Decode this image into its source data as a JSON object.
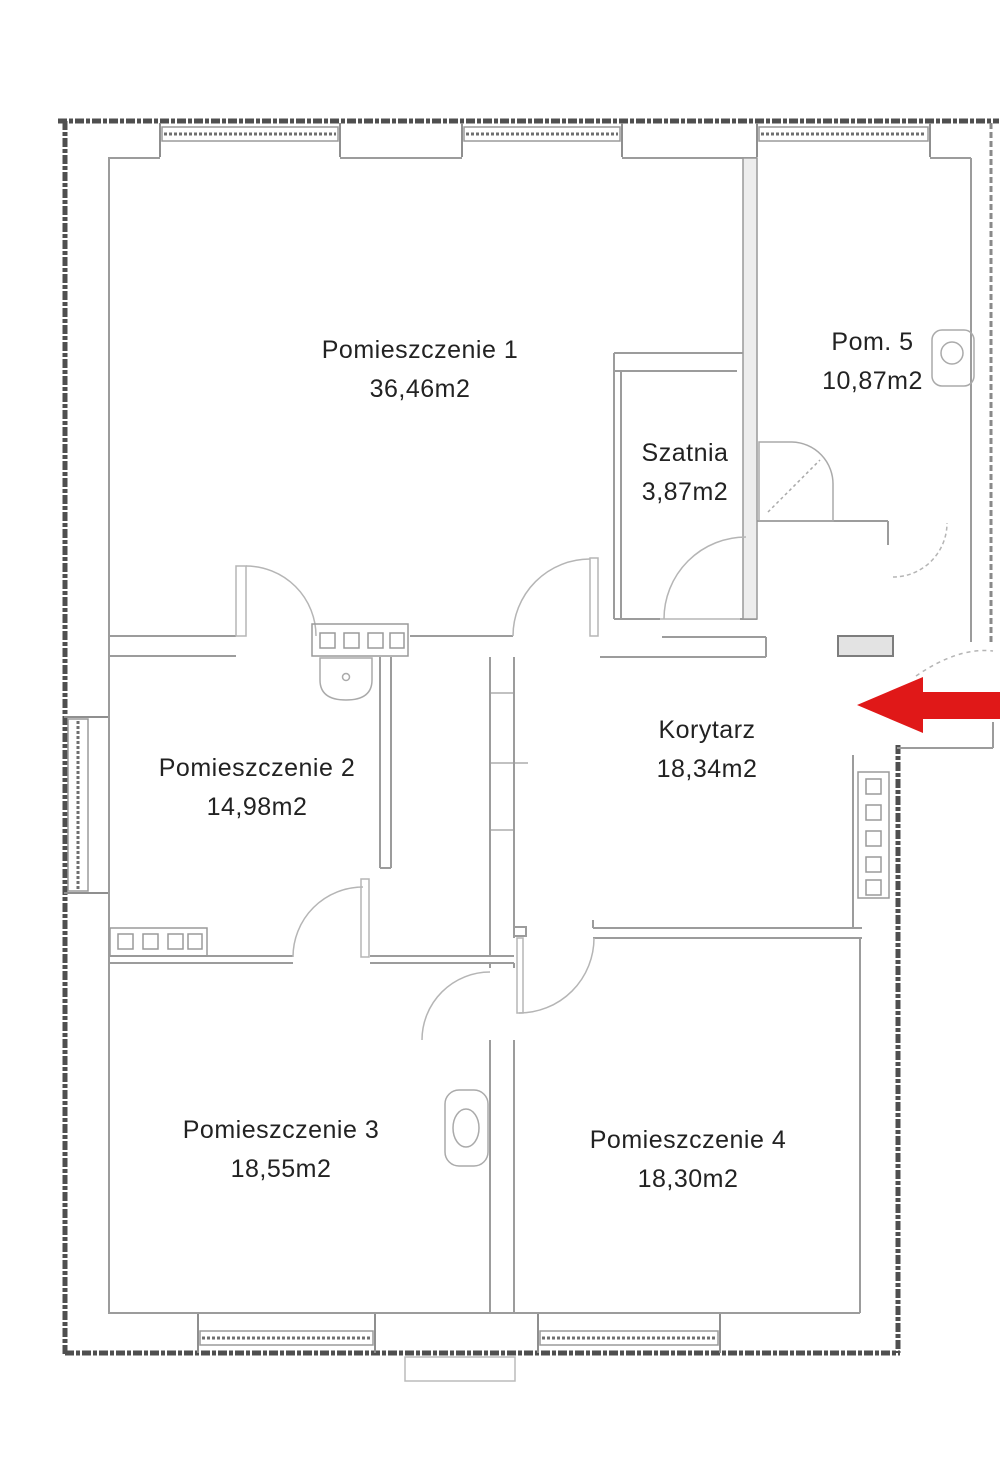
{
  "plan": {
    "title": "apartment floor plan",
    "rooms": [
      {
        "id": "room1",
        "name": "Pomieszczenie 1",
        "area": "36,46m2"
      },
      {
        "id": "room2",
        "name": "Pomieszczenie 2",
        "area": "14,98m2"
      },
      {
        "id": "room3",
        "name": "Pomieszczenie 3",
        "area": "18,55m2"
      },
      {
        "id": "room4",
        "name": "Pomieszczenie 4",
        "area": "18,30m2"
      },
      {
        "id": "room5",
        "name": "Pom. 5",
        "area": "10,87m2"
      },
      {
        "id": "szatnia",
        "name": "Szatnia",
        "area": "3,87m2"
      },
      {
        "id": "korytarz",
        "name": "Korytarz",
        "area": "18,34m2"
      }
    ],
    "entrance_arrow": {
      "direction": "left",
      "color": "#e01818"
    },
    "colors": {
      "background": "#ffffff",
      "wall_dark": "#4f4f4f",
      "wall_medium": "#8f8f8f",
      "line_light": "#b5b5b5",
      "text": "#222222",
      "arrow": "#e01818"
    }
  }
}
